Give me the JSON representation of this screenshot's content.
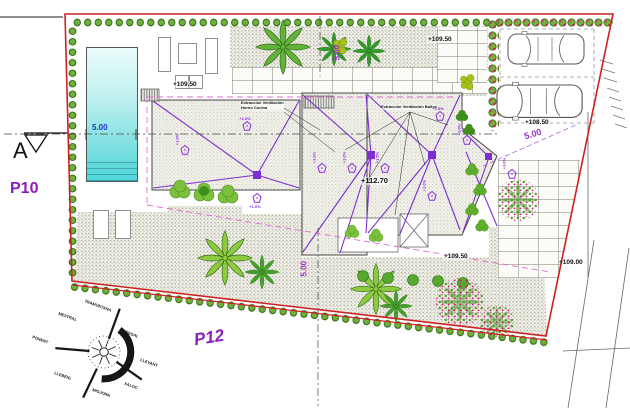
{
  "labels": {
    "parcel_left": "P10",
    "parcel_bottom": "P12",
    "section": "A"
  },
  "elevations": {
    "terrace": "+109.50",
    "garden_top": "+109.50",
    "parking": "+108.50",
    "roof": "+112.70",
    "garden_bottom": "+109.50",
    "street": "+109.00"
  },
  "dimensions": {
    "pool": "5.00",
    "top": "5.00",
    "right": "5.00",
    "bottom": "5.00"
  },
  "annotations": {
    "vent_kitchen_1": "Extracción Ventilación",
    "vent_kitchen_2": "Horno Cocina",
    "vent_bath": "Extracción Ventilación Baños",
    "slope": "+1.0%",
    "slope_alt": "+1.5%"
  },
  "compass": {
    "n": "TRAMUNTANA",
    "ne": "GREGAL",
    "e": "LLEVANT",
    "se": "XALOC",
    "s": "MIGJORN",
    "sw": "LLEBEIG",
    "w": "PONENT",
    "nw": "MESTRAL"
  },
  "colors": {
    "boundary": "#cc2222",
    "hedge": "#6fb03a",
    "pool": "#4fd4d8",
    "drain": "#7b2fd0",
    "dimension": "#9a30c9",
    "pool_dim_blue": "#2233cc",
    "setback": "#e06ad0",
    "flower": "#c2185b"
  }
}
